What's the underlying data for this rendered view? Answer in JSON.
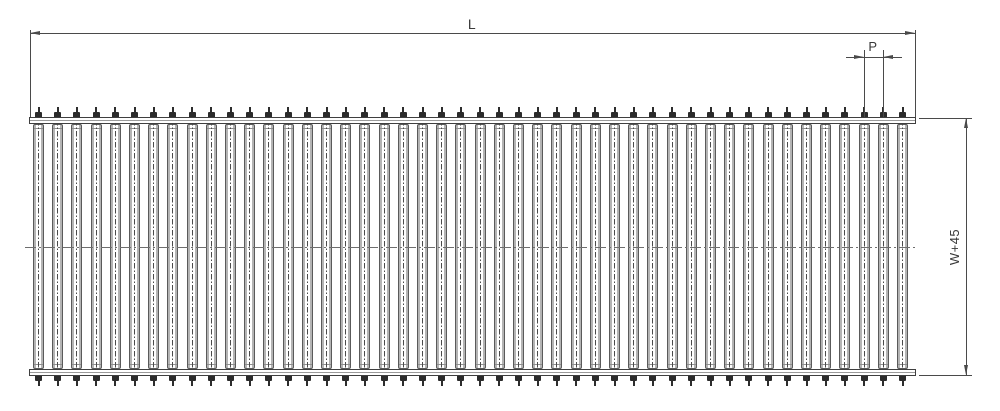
{
  "drawing": {
    "type": "technical-drawing",
    "view": "roller-conveyor-plan-view",
    "dim_length": {
      "label": "L"
    },
    "dim_pitch": {
      "label": "P"
    },
    "dim_width": {
      "label": "W+45"
    },
    "rollers": {
      "count": 46,
      "pitch": 19.2,
      "first_center_x": 38.5,
      "body_width": 11
    },
    "colors": {
      "line": "#3f3f3f",
      "dim": "#4a4a4a",
      "roller_wall": "#b4b4b4",
      "centerline": "#6e6e6e",
      "background": "#ffffff"
    }
  }
}
